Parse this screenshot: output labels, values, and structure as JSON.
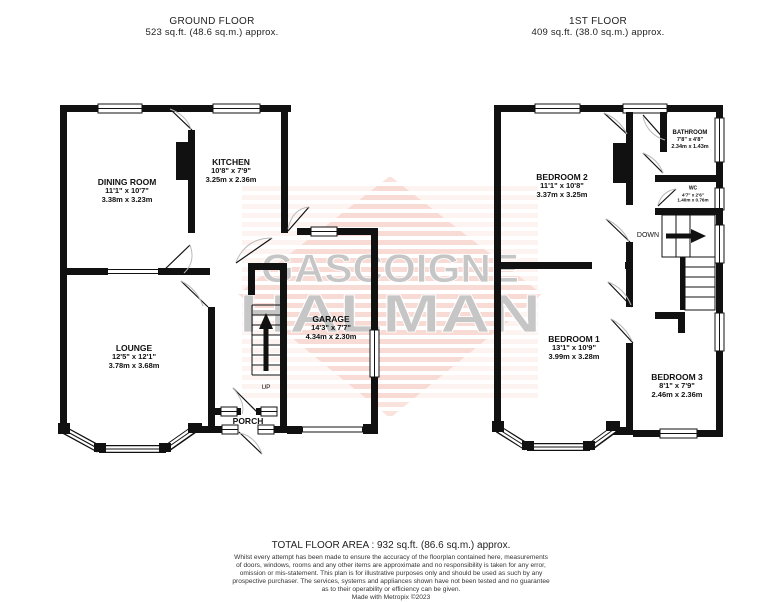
{
  "ground_floor": {
    "title": "GROUND FLOOR",
    "area": "523 sq.ft. (48.6 sq.m.) approx.",
    "rooms": [
      {
        "name": "DINING ROOM",
        "dims_ft": "11'1\"  x 10'7\"",
        "dims_m": "3.38m  x 3.23m"
      },
      {
        "name": "KITCHEN",
        "dims_ft": "10'8\"  x 7'9\"",
        "dims_m": "3.25m  x 2.36m"
      },
      {
        "name": "LOUNGE",
        "dims_ft": "12'5\"  x 12'1\"",
        "dims_m": "3.78m  x 3.68m"
      },
      {
        "name": "GARAGE",
        "dims_ft": "14'3\"  x 7'7\"",
        "dims_m": "4.34m  x 2.30m"
      },
      {
        "name": "PORCH"
      }
    ],
    "labels": {
      "up": "UP"
    }
  },
  "first_floor": {
    "title": "1ST FLOOR",
    "area": "409 sq.ft. (38.0 sq.m.) approx.",
    "rooms": [
      {
        "name": "BEDROOM 2",
        "dims_ft": "11'1\"  x 10'8\"",
        "dims_m": "3.37m  x 3.25m"
      },
      {
        "name": "BATHROOM",
        "dims_ft": "7'8\"  x 4'8\"",
        "dims_m": "2.34m  x 1.43m"
      },
      {
        "name": "WC",
        "dims_ft": "4'7\"  x 2'6\"",
        "dims_m": "1.40m  x 0.76m"
      },
      {
        "name": "BEDROOM 1",
        "dims_ft": "13'1\"  x 10'9\"",
        "dims_m": "3.99m  x 3.28m"
      },
      {
        "name": "BEDROOM 3",
        "dims_ft": "8'1\"  x 7'9\"",
        "dims_m": "2.46m  x 2.36m"
      }
    ],
    "labels": {
      "down": "DOWN"
    }
  },
  "watermark": {
    "line1": "GASCOIGNE",
    "line2": "HALMAN",
    "text_color": "#c6c6c6",
    "stripe_color": "#f3b9ad"
  },
  "footer": {
    "total": "TOTAL FLOOR AREA : 932 sq.ft. (86.6 sq.m.) approx.",
    "disclaimer_lines": [
      "Whilst every attempt has been made to ensure the accuracy of the floorplan contained here, measurements",
      "of doors, windows, rooms and any other items are approximate and no responsibility is taken for any error,",
      "omission or mis-statement. This plan is for illustrative purposes only and should be used as such by any",
      "prospective purchaser. The services, systems and appliances shown have not been tested and no guarantee",
      "as to their operability or efficiency can be given.",
      "Made with Metropix ©2023"
    ]
  }
}
